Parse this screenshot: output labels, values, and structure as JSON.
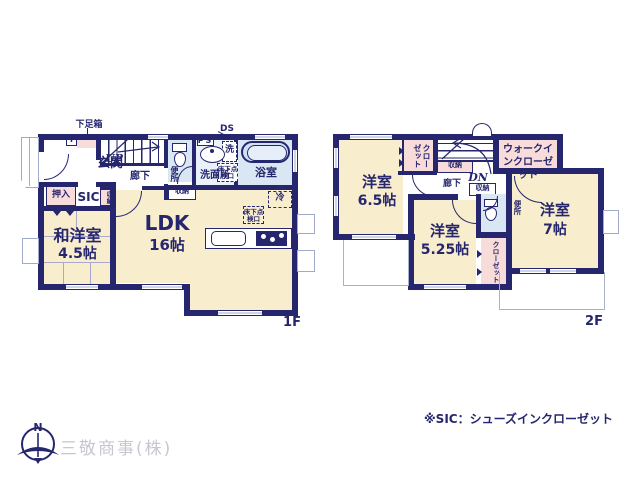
{
  "floor1": {
    "floor_label": "1F",
    "shoe_box": "下足箱",
    "entrance_t": "T",
    "entrance": "玄関",
    "stairs_up": "UP",
    "hallway": "廊下",
    "toilet": "便所",
    "ps": "PS",
    "ds": "DS",
    "washer": "洗",
    "washroom": "洗面所",
    "underfloor_hatch_a": "床下点検口",
    "bathroom": "浴室",
    "storage_side": "収納",
    "storage_hall": "収納",
    "oshiire": "押入",
    "sic": "SIC",
    "japanese_western_room": "和洋室",
    "japanese_western_room_size": "4.5帖",
    "ldk": "LDK",
    "ldk_size": "16帖",
    "fridge": "冷",
    "underfloor_hatch_b": "床下点検口"
  },
  "floor2": {
    "floor_label": "2F",
    "closet_a": "クローゼット",
    "storage_stairs": "収納",
    "stairs_down": "DN",
    "hallway": "廊下",
    "storage_hall": "収納",
    "walk_in_closet": "ウォークインクローゼット",
    "toilet": "便所",
    "bedroom_a": "洋室",
    "bedroom_a_size": "6.5帖",
    "bedroom_b": "洋室",
    "bedroom_b_size": "5.25帖",
    "bedroom_c": "洋室",
    "bedroom_c_size": "7帖",
    "closet_b": "クローゼット"
  },
  "footer": {
    "compass_north": "N",
    "company": "三敬商事(株)",
    "sic_note": "※SIC：シューズインクローゼット"
  },
  "palette": {
    "wall_navy": "#26266e",
    "room_cream": "#f8edcc",
    "closet_pink": "#f8dcd9",
    "wet_blue": "#d9e7f4",
    "washroom_blue": "#e9f1fa",
    "window_gray": "#9fabc8",
    "balcony_gray": "#a8b2ca",
    "company_gray": "#c7c7d0"
  }
}
